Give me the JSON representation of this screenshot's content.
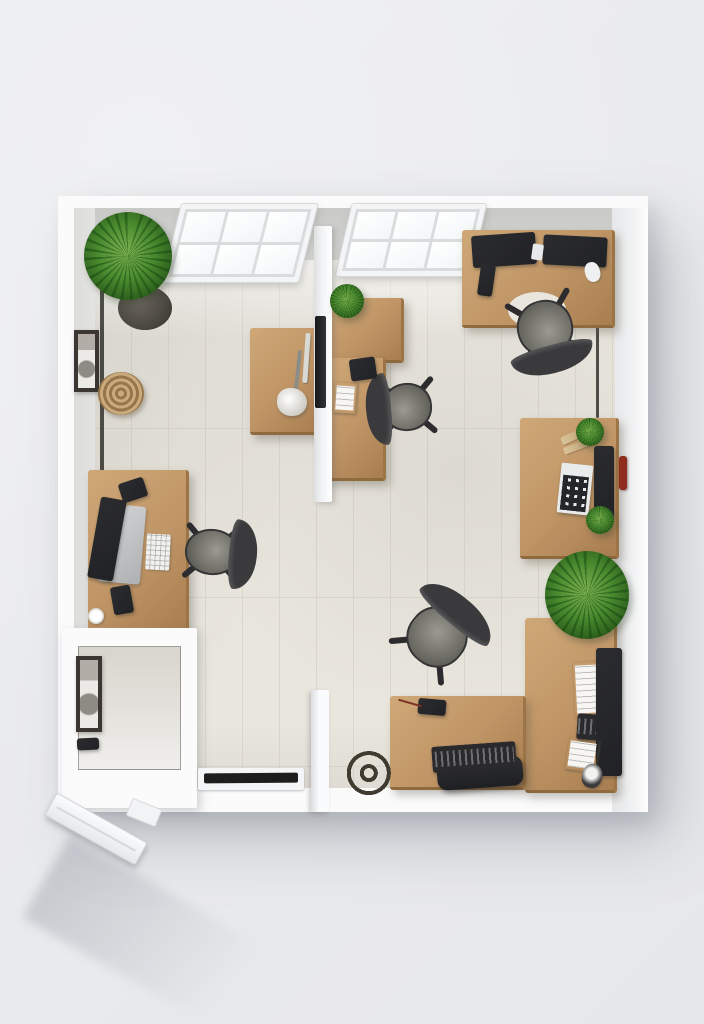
{
  "meta": {
    "description": "Photorealistic top-down 3D render of a small square office: white walls, two skylight windows on the top wall, light-oak desks with dark monitors, keyboards and four grey office chairs, a white centre partition panel, five green potted plants, a woven basket, framed pictures, a storage nook at the lower left, a black door threshold, a coiled cable, and an entry door swung open outward at the bottom-left corner"
  },
  "palette": {
    "bg": "#ebecee",
    "room-white": "#fbfbfc",
    "wall-face": "#d6d6d4",
    "wall-face-light": "#e4e4e2",
    "wall-face-right": "#f0f1f2",
    "floor": "#e9e6de",
    "floor-line": "#dbd7cd",
    "wood-hi": "#cfa878",
    "wood": "#c09566",
    "wood-lo": "#a87e50",
    "chair-dark": "#3a3a3c",
    "chair-gray": "#84847c",
    "plant": "#4a8a2f",
    "plant-dark": "#2c5f1c",
    "pot": "#49463f",
    "monitor": "#212225",
    "partition": "#f2f3f5",
    "frame-dark": "#3b3631",
    "basket": "#b4955f",
    "paper": "#f7f6f3",
    "red-accent": "#8e2d1e",
    "threshold": "#1d1d1d",
    "shadow": "rgba(130,135,146,0.45)"
  },
  "inventory": {
    "room": {
      "label": "Office room",
      "walls": "white",
      "floor": "light plank tile"
    },
    "skylight_windows": {
      "label": "Skylight window",
      "count": 2,
      "panes_per_window": 6
    },
    "desks": {
      "label": "Wooden desk",
      "count": 8
    },
    "office_chairs": {
      "label": "Office chair",
      "count": 4
    },
    "potted_plants": {
      "label": "Potted plant",
      "count": 5
    },
    "monitors": {
      "label": "Monitor / screen",
      "count": 6
    },
    "keyboards": {
      "label": "Keyboard / calculator",
      "count": 4
    },
    "wall_art": {
      "label": "Framed picture",
      "count": 2
    },
    "basket": {
      "label": "Woven basket",
      "count": 1
    },
    "partition": {
      "label": "White partition panel",
      "count": 1
    },
    "storage_nook": {
      "label": "Storage nook",
      "count": 1
    },
    "entry_door": {
      "label": "Open entry door",
      "count": 1
    },
    "cable_coil": {
      "label": "Coiled cable",
      "count": 1
    },
    "fire_fixture": {
      "label": "Red wall fixture",
      "count": 1
    }
  }
}
